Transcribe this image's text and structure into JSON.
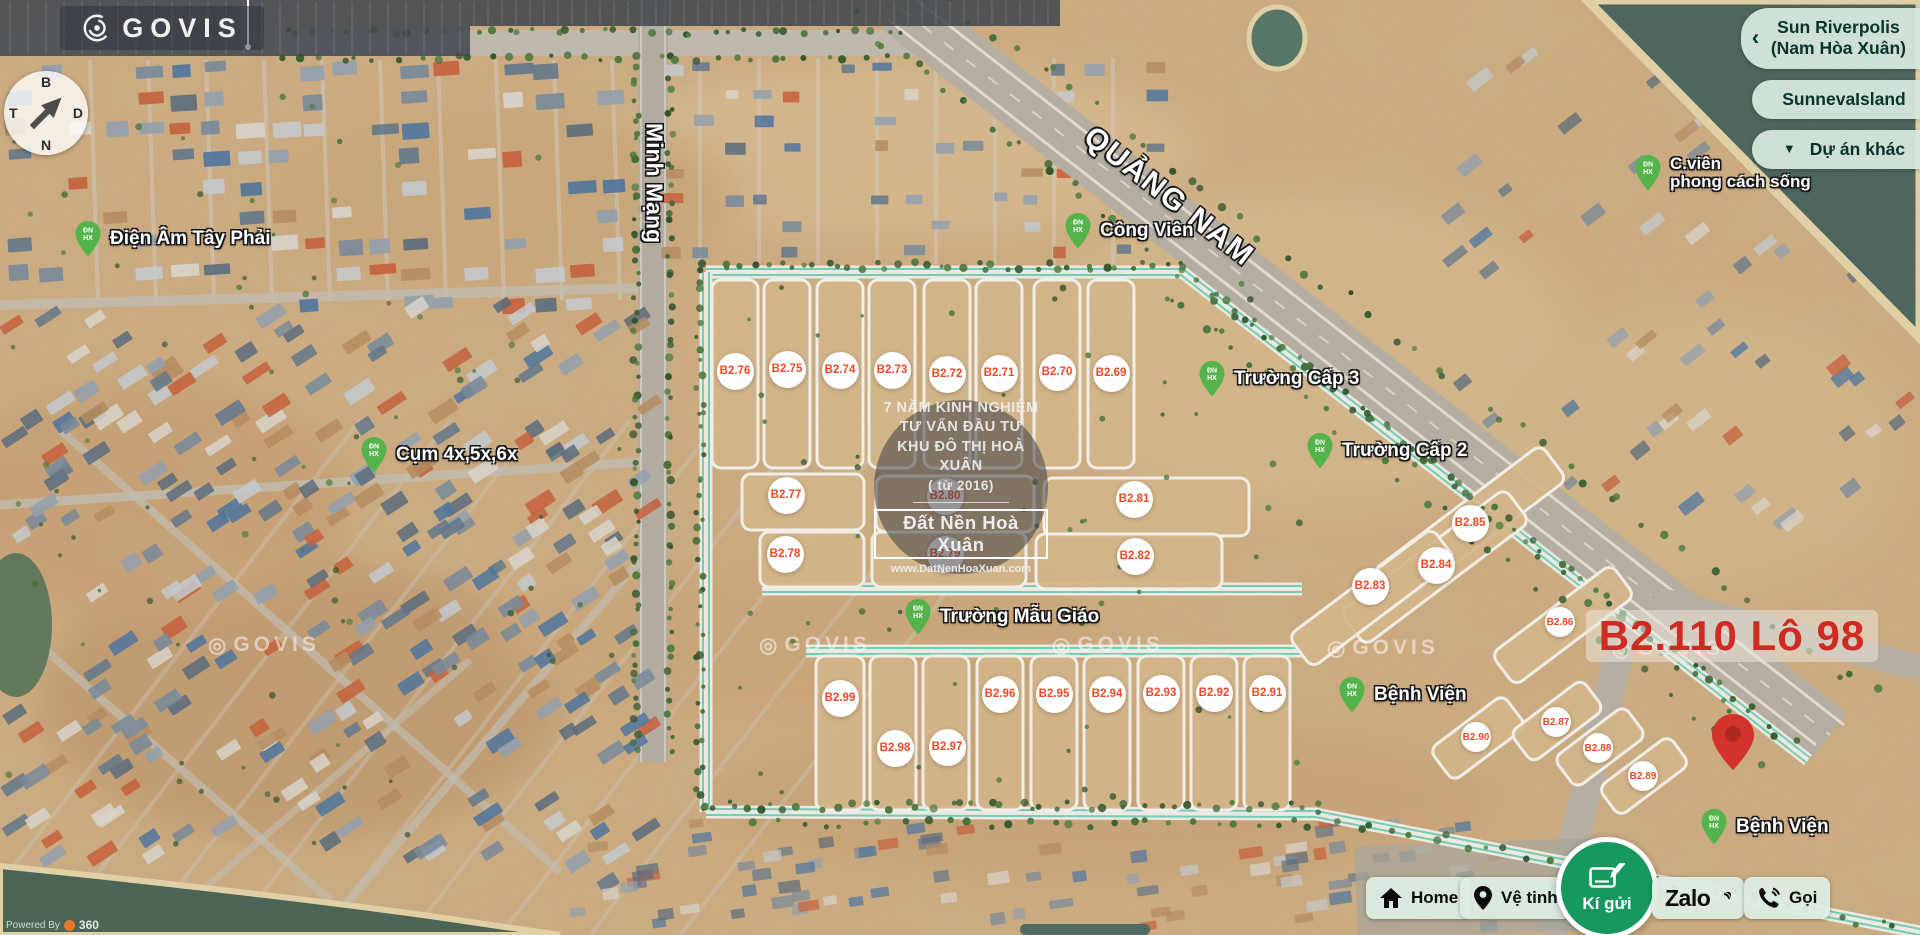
{
  "brand": {
    "logo_text": "GOVIS",
    "watermark_text": "GOVIS",
    "powered_by": "Powered By",
    "powered_suffix": "360"
  },
  "compass": {
    "north": "B",
    "east": "D",
    "south": "N",
    "west": "T"
  },
  "project_nav": [
    {
      "label": "Sun Riverpolis\n(Nam Hòa Xuân)",
      "icon": "chevron-left",
      "icon_char": "‹"
    },
    {
      "label": "SunnevaIsland",
      "icon": null,
      "icon_char": ""
    },
    {
      "label": "Dự án khác",
      "icon": "caret-down",
      "icon_char": "▼"
    }
  ],
  "roads": {
    "vertical": "Minh Mạng",
    "diagonal": "QUẢNG NAM"
  },
  "poi_pin": {
    "monogram": [
      "ĐN",
      "HX"
    ],
    "color": "#54b34a"
  },
  "pois": [
    {
      "name": "Điện Âm Tây Phải",
      "x": 88,
      "y": 236
    },
    {
      "name": "Cụm 4x,5x,6x",
      "x": 374,
      "y": 452
    },
    {
      "name": "Công Viên",
      "x": 1078,
      "y": 228
    },
    {
      "name": "Trường Cấp 3",
      "x": 1212,
      "y": 376
    },
    {
      "name": "Trường Cấp 2",
      "x": 1320,
      "y": 448
    },
    {
      "name": "Trường Mẫu Giáo",
      "x": 918,
      "y": 614
    },
    {
      "name": "Bệnh Viện",
      "x": 1352,
      "y": 692
    },
    {
      "name": "C.viên\nphong cách sống",
      "x": 1648,
      "y": 170,
      "two_line": true
    },
    {
      "name": "Bệnh Viện",
      "x": 1714,
      "y": 824
    }
  ],
  "lots": [
    {
      "id": "B2.76",
      "x": 735,
      "y": 371
    },
    {
      "id": "B2.75",
      "x": 787,
      "y": 369
    },
    {
      "id": "B2.74",
      "x": 840,
      "y": 370
    },
    {
      "id": "B2.73",
      "x": 892,
      "y": 370
    },
    {
      "id": "B2.72",
      "x": 947,
      "y": 374
    },
    {
      "id": "B2.71",
      "x": 999,
      "y": 373
    },
    {
      "id": "B2.70",
      "x": 1057,
      "y": 372
    },
    {
      "id": "B2.69",
      "x": 1111,
      "y": 373
    },
    {
      "id": "B2.77",
      "x": 786,
      "y": 495
    },
    {
      "id": "B2.80",
      "x": 945,
      "y": 496
    },
    {
      "id": "B2.81",
      "x": 1134,
      "y": 499
    },
    {
      "id": "B2.78",
      "x": 785,
      "y": 554
    },
    {
      "id": "B2.79",
      "x": 945,
      "y": 554
    },
    {
      "id": "B2.82",
      "x": 1135,
      "y": 556
    },
    {
      "id": "B2.85",
      "x": 1470,
      "y": 523
    },
    {
      "id": "B2.84",
      "x": 1436,
      "y": 565
    },
    {
      "id": "B2.83",
      "x": 1370,
      "y": 586
    },
    {
      "id": "B2.86",
      "x": 1560,
      "y": 622,
      "small": true
    },
    {
      "id": "B2.99",
      "x": 840,
      "y": 698
    },
    {
      "id": "B2.96",
      "x": 1000,
      "y": 694
    },
    {
      "id": "B2.95",
      "x": 1054,
      "y": 694
    },
    {
      "id": "B2.94",
      "x": 1107,
      "y": 694
    },
    {
      "id": "B2.93",
      "x": 1161,
      "y": 693
    },
    {
      "id": "B2.92",
      "x": 1214,
      "y": 693
    },
    {
      "id": "B2.91",
      "x": 1267,
      "y": 693
    },
    {
      "id": "B2.98",
      "x": 895,
      "y": 748
    },
    {
      "id": "B2.97",
      "x": 947,
      "y": 747
    },
    {
      "id": "B2.90",
      "x": 1476,
      "y": 737,
      "small": true
    },
    {
      "id": "B2.87",
      "x": 1556,
      "y": 722,
      "small": true
    },
    {
      "id": "B2.88",
      "x": 1598,
      "y": 748,
      "small": true
    },
    {
      "id": "B2.89",
      "x": 1643,
      "y": 776,
      "small": true
    }
  ],
  "watermark_circle": {
    "experience_lines": [
      "7 NĂM KINH NGHIỆM",
      "TƯ VẤN ĐẦU TƯ",
      "KHU ĐÔ THỊ HOÀ XUÂN",
      "( từ 2016)"
    ],
    "brand_name": "Đất Nền Hoà Xuân",
    "website": "www.DatNenHoaXuan.com"
  },
  "highlight": {
    "label": "B2.110 Lô 98",
    "color": "#ce2b22"
  },
  "actions": [
    {
      "label": "Home",
      "icon": "home-icon"
    },
    {
      "label": "Vệ tinh",
      "icon": "map-pin-icon"
    },
    {
      "label": "Kí gửi",
      "icon": "note-pencil-icon",
      "primary": true
    },
    {
      "label": "Zalo",
      "icon": "zalo-logo"
    },
    {
      "label": "Gọi",
      "icon": "phone-icon"
    }
  ],
  "colors": {
    "marker_text": "#ee4a26",
    "highlight_red": "#ce2b22",
    "pin_green": "#54b34a",
    "action_green": "#17985f",
    "button_mint": "#d6e8dd",
    "teal_road": "#6fd0b8"
  }
}
